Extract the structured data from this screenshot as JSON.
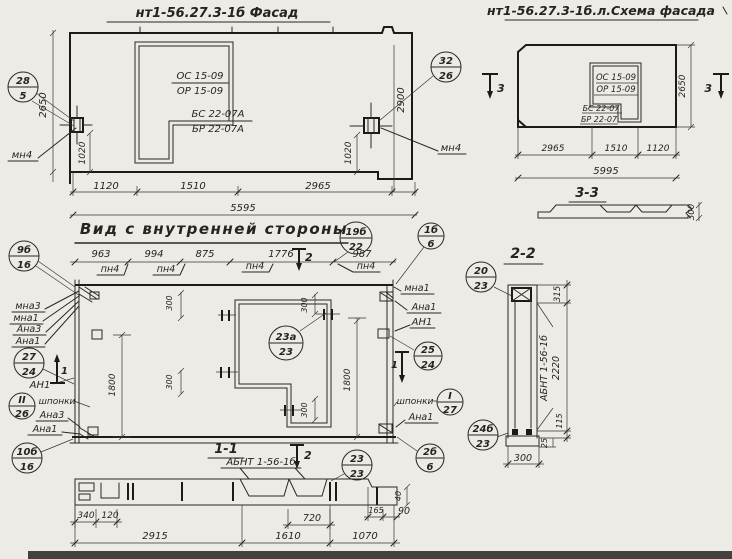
{
  "palette": {
    "paper": "#ecebe6",
    "ink": "#27241e"
  },
  "facade": {
    "title": "нт1-56.27.3-1б Фасад",
    "win_top": "ОС 15-09",
    "win_bot": "ОР 15-09",
    "panel_top": "БС 22-07А",
    "panel_bot": "БР 22-07А",
    "dim_1120": "1120",
    "dim_1510": "1510",
    "dim_2965": "2965",
    "dim_total": "5595",
    "dim_height": "2650",
    "dim_right": "2900",
    "dim_embed": "1020",
    "embed_label": "мн4",
    "callout_left": {
      "t": "28",
      "b": "5"
    },
    "callout_right": {
      "t": "32",
      "b": "26"
    }
  },
  "scheme": {
    "title": "нт1-56.27.3-1б.л.Схема фасада",
    "win_top": "ОС 15-09",
    "win_bot": "ОР 15-09",
    "panel_top": "БС 22-07",
    "panel_bot": "БР 22-07",
    "dim_2965": "2965",
    "dim_1510": "1510",
    "dim_1120": "1120",
    "dim_total": "5995",
    "dim_height": "2650",
    "marker": "3"
  },
  "section33": {
    "title": "3-3",
    "thickness": "300"
  },
  "inner": {
    "title": "Вид с внутренней стороны",
    "dim_963": "963",
    "dim_994": "994",
    "dim_875": "875",
    "dim_1776": "1776",
    "dim_987": "987",
    "pn4": "пн4",
    "marker_top": "2",
    "marker_side": "1",
    "dim_300": "300",
    "dim_1800": "1800",
    "lbl_mna3": "мна3",
    "lbl_mna1": "мна1",
    "lbl_ana3": "Ана3",
    "lbl_ana1": "Ана1",
    "lbl_an1": "АН1",
    "lbl_shponki": "шпонки",
    "callouts": {
      "c9b": {
        "t": "9б",
        "b": "16"
      },
      "c19b": {
        "t": "19б",
        "b": "22"
      },
      "c1b": {
        "t": "1б",
        "b": "6"
      },
      "c27": {
        "t": "27",
        "b": "24"
      },
      "cII": {
        "t": "II",
        "b": "26"
      },
      "c10b": {
        "t": "10б",
        "b": "16"
      },
      "c23a": {
        "t": "23а",
        "b": "23"
      },
      "c25": {
        "t": "25",
        "b": "24"
      },
      "cI": {
        "t": "I",
        "b": "27"
      },
      "c2b": {
        "t": "2б",
        "b": "6"
      }
    }
  },
  "section11": {
    "title": "1-1",
    "marker": "2",
    "label": "АБНТ 1-56-1б",
    "dim_340": "340",
    "dim_120": "120",
    "dim_2915": "2915",
    "dim_720": "720",
    "dim_1610": "1610",
    "dim_1070": "1070",
    "dim_165": "165",
    "dim_90": "90",
    "dim_40": "40",
    "callout": {
      "t": "23",
      "b": "23"
    }
  },
  "section22": {
    "title": "2-2",
    "label": "АБНТ 1-56-1б",
    "dim_315": "315",
    "dim_2220": "2220",
    "dim_115": "115",
    "dim_25": "25",
    "dim_300": "300",
    "callout_top": {
      "t": "20",
      "b": "23"
    },
    "callout_bottom": {
      "t": "24б",
      "b": "23"
    }
  }
}
